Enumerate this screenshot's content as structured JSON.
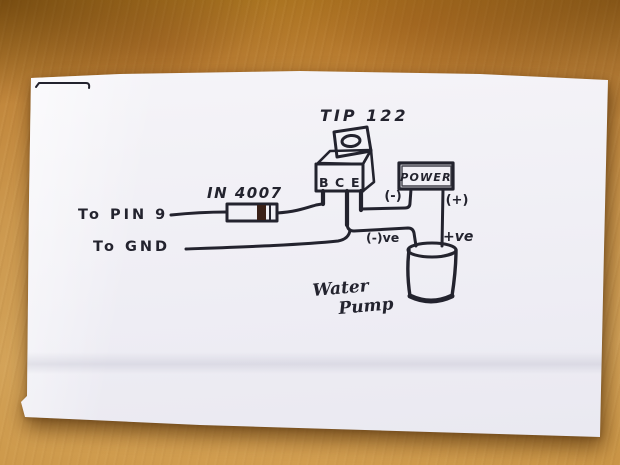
{
  "colors": {
    "ink": "#23232e",
    "paper": "#f2f1f6",
    "wood": "#c58c3c",
    "diode_band": "#3a2118",
    "blue_mark": "#2e59b0"
  },
  "diagram": {
    "transistor": {
      "label": "TIP 122",
      "pins": [
        "B",
        "C",
        "E"
      ]
    },
    "diode": {
      "label": "IN 4007"
    },
    "inputs": {
      "signal": "To PIN 9",
      "ground": "To GND"
    },
    "power": {
      "label": "POWER",
      "negative": "(-)",
      "positive": "(+)"
    },
    "pump": {
      "label_line1": "Water",
      "label_line2": "Pump",
      "negative": "(-)ve",
      "positive": "+ve"
    }
  }
}
